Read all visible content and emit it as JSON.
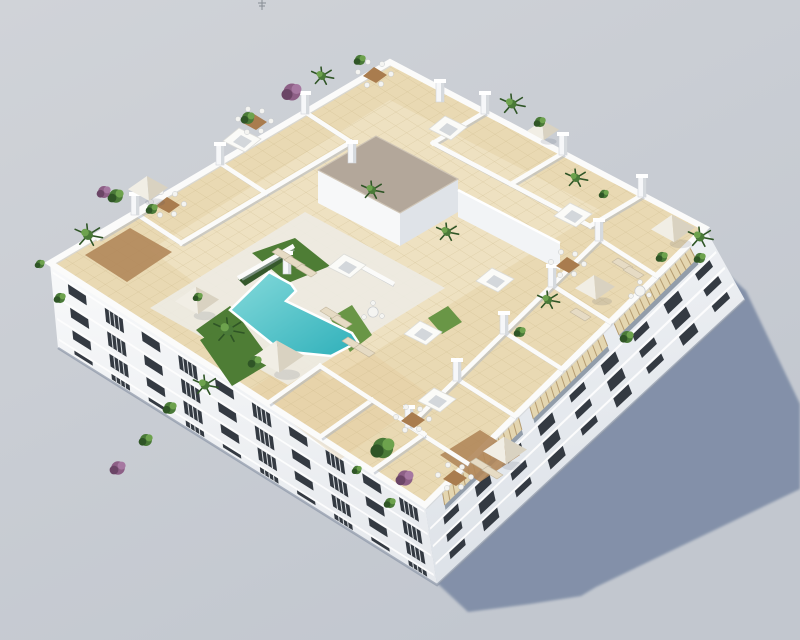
{
  "meta": {
    "alt": "Aerial 3D architectural render of a white apartment block with a rooftop terrace: L-shaped turquoise pool, artificial grass, white parasols, sun loungers, dining sets, green and purple plants, white parapet walls, skylights, a grey-roofed stair core, wooden pergolas on the right facade, long blue-grey shadow cast on a plain grey ground"
  },
  "colors": {
    "bg_top": "#d0d3d8",
    "bg_bottom": "#c2c7cf",
    "shadow": "#7e8ca6",
    "base_line": "#8b95a6",
    "facadeL_top": "#f8f9fa",
    "facadeL_bot": "#e7eaee",
    "facadeR_top": "#f0f2f5",
    "facadeR_bot": "#dde2e8",
    "window": "#343a42",
    "ledge": "#fdfdfd",
    "railing": "#dfe3e7",
    "roof_tile": "#e9d9b3",
    "roof_tile_light": "#f4ead0",
    "tile_line": "#c8b384",
    "roof_warm": "#e3c796",
    "parapet": "#fbfbfa",
    "parapet_shade": "#d4d7da",
    "wall": "#fbfbfa",
    "wall_shadow": "#b2b9c4",
    "pool_deck": "#edebe3",
    "pool_light": "#85dadb",
    "pool_dark": "#2fb0ba",
    "pool_edge": "#ffffff",
    "grass": "#4e7d35",
    "grass_light": "#699646",
    "hedge": "#35582b",
    "core_roof": "#b3a79a",
    "core_edge": "#cfc5b6",
    "wood_deck": "#b1875a",
    "pergola_wood": "#e4d6b0",
    "pergola_slat": "#b59c71",
    "pergola_under": "#929daa",
    "plant_green": "#4a7a38",
    "plant_light": "#6da24d",
    "plant_dark": "#2f5526",
    "plant_purple": "#8d5f86",
    "plant_purple_light": "#a678a1",
    "plant_purple_dark": "#6b4566",
    "parasol_light": "#f1eee5",
    "parasol_shade": "#d9d2c1",
    "lounger": "#e6dbc4",
    "lounger_edge": "#c3b79e",
    "table_wood": "#a97c4e",
    "chair": "#f4f4f1",
    "chair_edge": "#c6c9cc",
    "pillar": "#f6f7f9",
    "pillar_shade": "#d6dade",
    "skylight": "#fbfbf8",
    "skylight_inner": "#d3d7db",
    "antenna": "#70767e"
  },
  "scene": {
    "facades": {
      "left": {
        "top": [
          [
            50,
            263
          ],
          [
            425,
            505
          ]
        ],
        "base": [
          [
            58,
            348
          ],
          [
            437,
            585
          ]
        ],
        "floors": [
          {
            "v": 0.12,
            "h": 0.115
          },
          {
            "v": 0.4,
            "h": 0.115
          },
          {
            "v": 0.665,
            "h": 0.105
          },
          {
            "v": 0.905,
            "h": 0.045
          }
        ],
        "n": 10,
        "u0": 0.045,
        "u1": 0.975,
        "w": 0.048,
        "ledges": [
          0.085,
          0.365,
          0.63,
          0.875
        ],
        "rails": true
      },
      "right": {
        "top": [
          [
            425,
            505
          ],
          [
            705,
            228
          ]
        ],
        "base": [
          [
            437,
            585
          ],
          [
            745,
            300
          ]
        ],
        "floors": [
          {
            "v": 0.33,
            "h": 0.09
          },
          {
            "v": 0.55,
            "h": 0.09
          },
          {
            "v": 0.77,
            "h": 0.085
          }
        ],
        "n": 9,
        "u0": 0.05,
        "u1": 0.97,
        "w": 0.05,
        "ledges": [
          0.3,
          0.52,
          0.74
        ],
        "rails": false
      }
    },
    "pergola": {
      "v0": 0.035,
      "v1": 0.21,
      "under_v1": 0.27,
      "segs": [
        [
          0.06,
          0.33
        ],
        [
          0.37,
          0.63
        ],
        [
          0.67,
          0.94
        ]
      ]
    },
    "walls": [
      [
        135,
        213,
        181,
        243
      ],
      [
        220,
        163,
        266,
        193
      ],
      [
        305,
        112,
        351,
        142
      ],
      [
        181,
        243,
        351,
        142
      ],
      [
        485,
        112,
        433,
        143
      ],
      [
        563,
        153,
        511,
        184
      ],
      [
        642,
        195,
        590,
        226
      ],
      [
        433,
        143,
        590,
        226
      ],
      [
        467,
        463,
        409,
        426
      ],
      [
        515,
        416,
        457,
        379
      ],
      [
        562,
        369,
        504,
        332
      ],
      [
        610,
        322,
        552,
        285
      ],
      [
        657,
        276,
        599,
        239
      ],
      [
        409,
        426,
        599,
        239
      ],
      [
        268,
        403,
        320,
        366
      ],
      [
        320,
        437,
        372,
        400
      ],
      [
        372,
        471,
        424,
        434
      ],
      [
        320,
        366,
        424,
        434
      ],
      [
        98,
        238,
        150,
        207
      ],
      [
        240,
        277,
        292,
        247
      ],
      [
        350,
        260,
        392,
        283
      ]
    ],
    "pillars": [
      [
        135,
        213
      ],
      [
        220,
        163
      ],
      [
        305,
        112
      ],
      [
        485,
        112
      ],
      [
        563,
        153
      ],
      [
        642,
        195
      ],
      [
        409,
        426
      ],
      [
        457,
        379
      ],
      [
        504,
        332
      ],
      [
        552,
        285
      ],
      [
        599,
        239
      ],
      [
        287,
        272
      ],
      [
        352,
        161
      ],
      [
        440,
        100
      ]
    ],
    "skylights": [
      [
        242,
        140
      ],
      [
        448,
        128
      ],
      [
        573,
        215
      ],
      [
        347,
        266
      ],
      [
        423,
        333
      ],
      [
        495,
        280
      ],
      [
        437,
        400
      ]
    ],
    "core_windows": [
      [
        415,
        225
      ],
      [
        437,
        214
      ],
      [
        478,
        212
      ],
      [
        506,
        226
      ],
      [
        532,
        239
      ]
    ],
    "plants": [
      [
        88,
        235,
        10,
        1
      ],
      [
        116,
        196,
        8,
        0
      ],
      [
        104,
        192,
        7,
        2
      ],
      [
        152,
        209,
        6,
        0
      ],
      [
        248,
        118,
        7,
        0
      ],
      [
        292,
        92,
        10,
        2
      ],
      [
        322,
        76,
        8,
        1
      ],
      [
        360,
        60,
        6,
        0
      ],
      [
        512,
        104,
        9,
        1
      ],
      [
        540,
        122,
        6,
        0
      ],
      [
        576,
        178,
        8,
        1
      ],
      [
        604,
        194,
        5,
        0
      ],
      [
        700,
        237,
        9,
        1
      ],
      [
        662,
        257,
        6,
        0
      ],
      [
        228,
        330,
        11,
        1
      ],
      [
        255,
        362,
        7,
        0
      ],
      [
        198,
        297,
        5,
        0
      ],
      [
        372,
        190,
        8,
        1
      ],
      [
        447,
        232,
        8,
        1
      ],
      [
        548,
        300,
        8,
        1
      ],
      [
        520,
        332,
        6,
        0
      ],
      [
        383,
        448,
        12,
        0
      ],
      [
        405,
        478,
        9,
        2
      ],
      [
        390,
        503,
        6,
        0
      ],
      [
        357,
        470,
        5,
        0
      ],
      [
        205,
        385,
        9,
        1
      ],
      [
        170,
        408,
        7,
        0
      ],
      [
        118,
        468,
        8,
        2
      ],
      [
        146,
        440,
        7,
        0
      ],
      [
        60,
        298,
        6,
        0
      ],
      [
        40,
        264,
        5,
        0
      ],
      [
        627,
        337,
        7,
        0
      ],
      [
        700,
        258,
        6,
        0
      ]
    ],
    "parasols": [
      [
        278,
        356,
        26
      ],
      [
        197,
        300,
        22
      ],
      [
        148,
        188,
        20
      ],
      [
        673,
        228,
        22
      ],
      [
        595,
        287,
        20
      ],
      [
        505,
        450,
        22
      ],
      [
        543,
        130,
        16
      ]
    ],
    "loungers": [
      [
        272,
        252
      ],
      [
        284,
        260
      ],
      [
        296,
        268
      ],
      [
        320,
        311
      ],
      [
        331,
        319
      ],
      [
        342,
        341
      ],
      [
        354,
        348
      ],
      [
        612,
        262
      ],
      [
        623,
        270
      ],
      [
        570,
        312
      ],
      [
        470,
        462
      ],
      [
        482,
        470
      ]
    ],
    "tables": [
      [
        168,
        205
      ],
      [
        255,
        122
      ],
      [
        375,
        75
      ],
      [
        413,
        420
      ],
      [
        455,
        478
      ],
      [
        568,
        265
      ]
    ],
    "round_tables": [
      [
        640,
        291
      ],
      [
        373,
        312
      ]
    ]
  }
}
